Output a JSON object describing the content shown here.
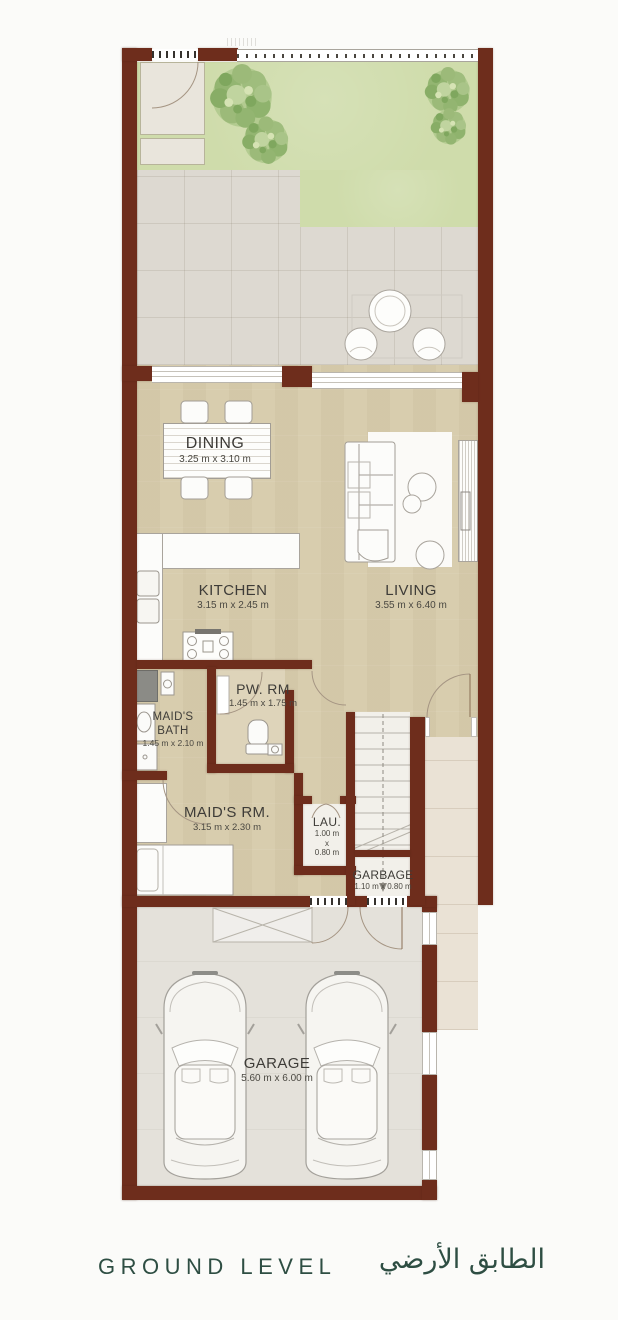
{
  "meta": {
    "type": "residential floor plan"
  },
  "footer": {
    "title_en": "GROUND LEVEL",
    "title_ar": "الطابق الأرضي"
  },
  "rooms": {
    "dining": {
      "name": "DINING",
      "dims": "3.25 m x 3.10 m"
    },
    "kitchen": {
      "name": "KITCHEN",
      "dims": "3.15 m x 2.45 m"
    },
    "living": {
      "name": "LIVING",
      "dims": "3.55 m x 6.40 m"
    },
    "powder": {
      "name": "PW. RM",
      "dims": "1.45 m x 1.75 m"
    },
    "maids_bath": {
      "line1": "MAID'S",
      "line2": "BATH",
      "dims": "1.45 m x 2.10 m"
    },
    "maids_room": {
      "name": "MAID'S RM.",
      "dims": "3.15 m x 2.30 m"
    },
    "laundry": {
      "name": "LAU.",
      "dims_l1": "1.00 m",
      "dims_l2": "x",
      "dims_l3": "0.80 m"
    },
    "garbage": {
      "name": "GARBAGE",
      "dims": "1.10 m x 0.80 m"
    },
    "garage": {
      "name": "GARAGE",
      "dims": "5.60 m x 6.00 m"
    }
  },
  "colors": {
    "wall": "#6e2d1c",
    "interior_floor": "#d8cdae",
    "grass": "#cfdcab",
    "patio": "#ddd9d1",
    "garage_floor": "#e4e1da",
    "walkway": "#eae2d5",
    "title_text": "#2e4e43",
    "label_text": "#3e3c38"
  }
}
